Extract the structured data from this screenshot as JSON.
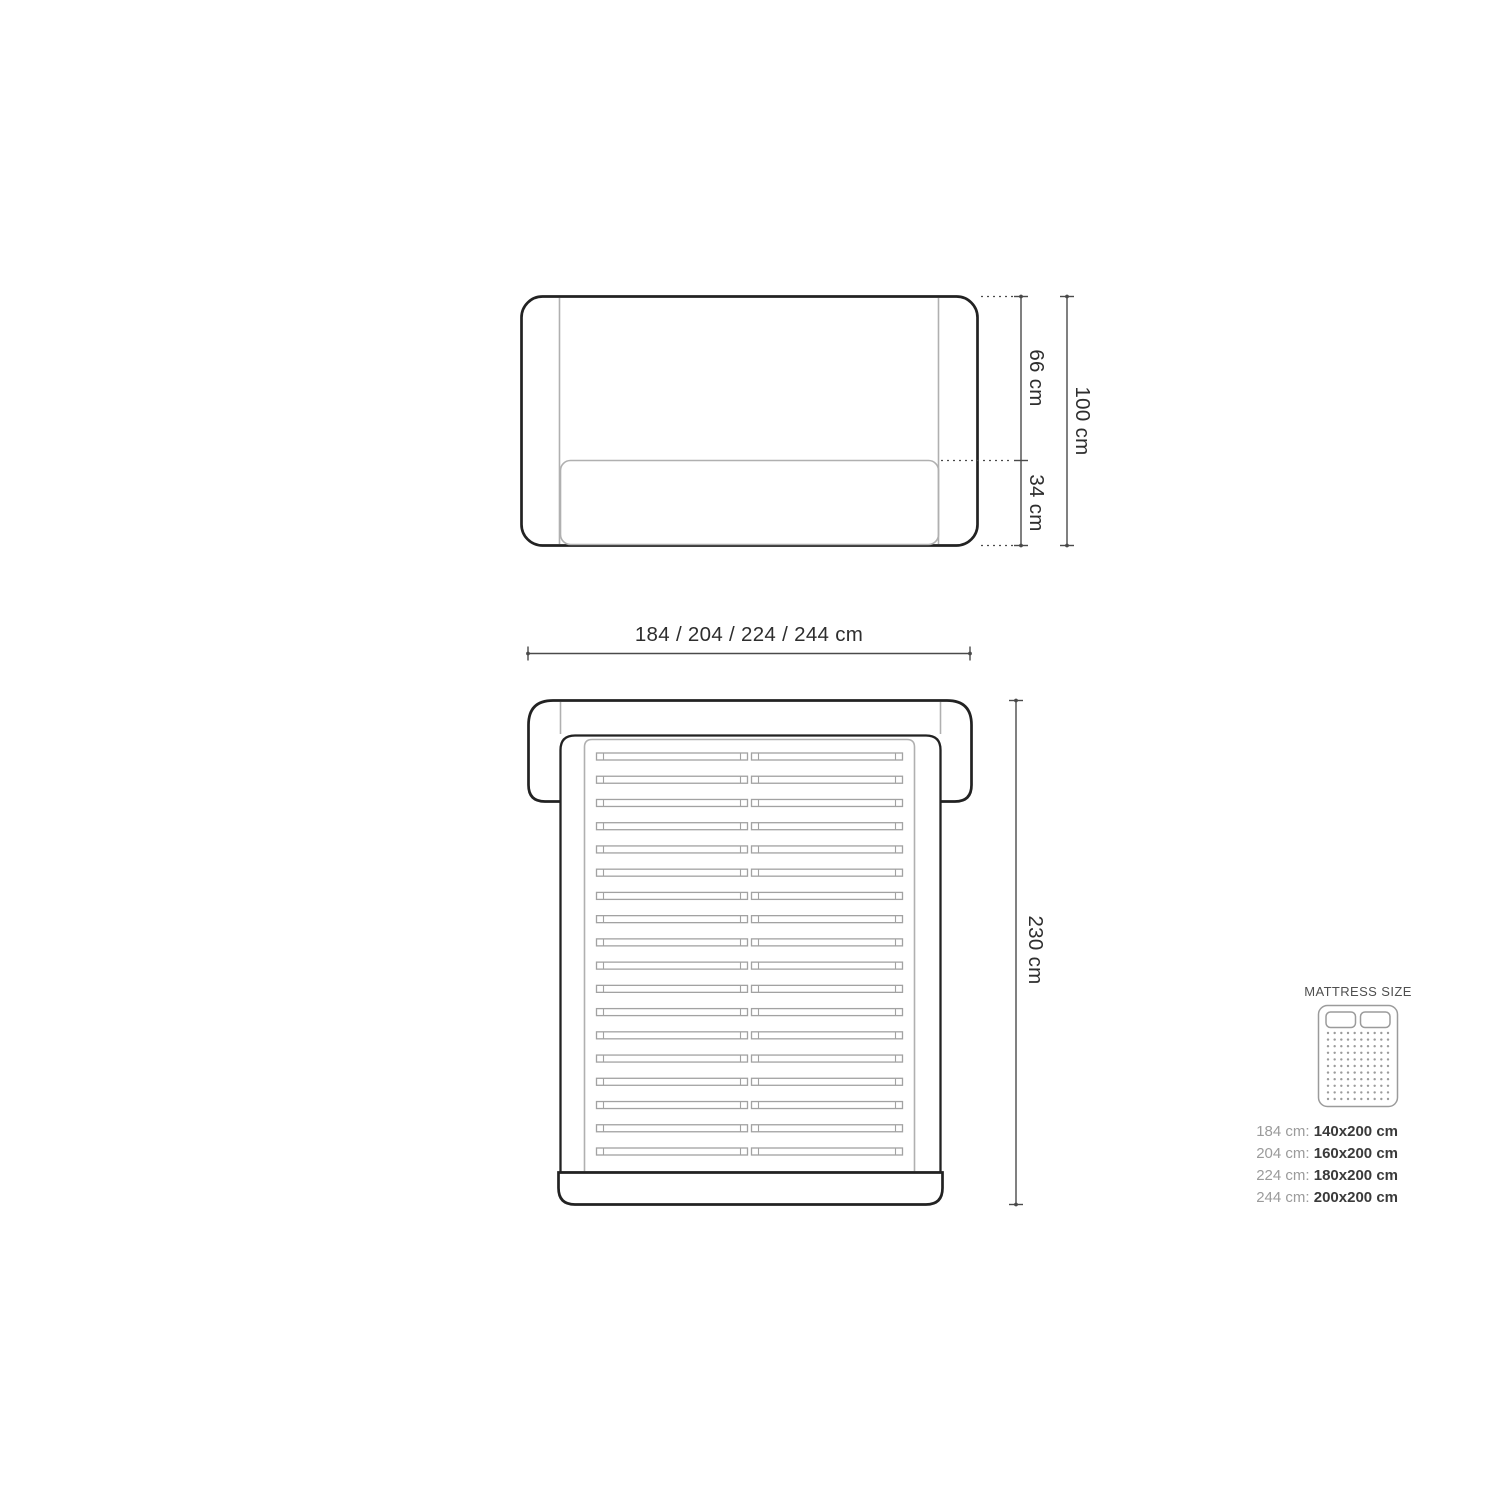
{
  "front_view": {
    "dim_upper_label": "66 cm",
    "dim_lower_label": "34 cm",
    "dim_total_label": "100 cm"
  },
  "plan_view": {
    "dim_width_label": "184 / 204 / 224 / 244 cm",
    "dim_length_label": "230 cm",
    "slat_rows": 18
  },
  "legend": {
    "title": "MATTRESS SIZE",
    "rows": [
      {
        "frame": "184 cm: ",
        "mattress": "140x200 cm"
      },
      {
        "frame": "204 cm: ",
        "mattress": "160x200 cm"
      },
      {
        "frame": "224 cm: ",
        "mattress": "180x200 cm"
      },
      {
        "frame": "244 cm: ",
        "mattress": "200x200 cm"
      }
    ],
    "dot_grid": {
      "cols": 10,
      "rows": 11
    }
  },
  "colors": {
    "outline": "#222222",
    "secondary": "#b0b0b0",
    "slat": "#a2a2a2",
    "dimension": "#4a4a4a",
    "label": "#2e2e2e",
    "legend_gray": "#9b9b9b",
    "legend_dark": "#3a3a3a"
  }
}
